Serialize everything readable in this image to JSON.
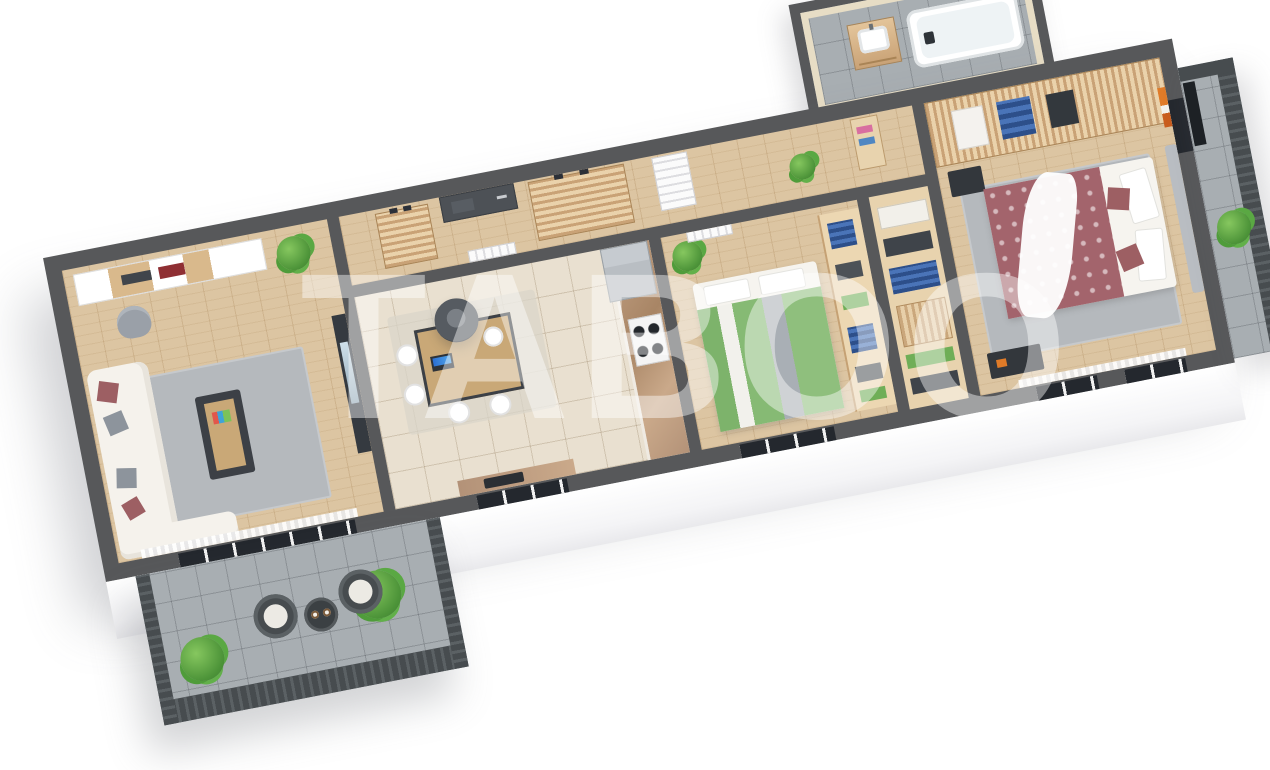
{
  "meta": {
    "type": "3d-isometric-floor-plan-render",
    "description": "Cutaway top-down 3D rendering of a 3-room apartment on a white background, rotated diagonally with the right end higher",
    "background": "#ffffff"
  },
  "watermark": {
    "text": "TABOO",
    "color": "#ffffff",
    "opacity": 0.44
  },
  "palette": {
    "wall_top": "#57585a",
    "wood_floor": "#dcc5a2",
    "kitchen_tile": "#e9e0d0",
    "balcony_tile": "#a8aeb2",
    "railing": "#474c4f",
    "wardrobe_wood": "#e0c49c",
    "sofa_white": "#f5f2ec",
    "pillow_red": "#9d5f63",
    "pillow_gray": "#8d949c",
    "bed_green": "#83b871",
    "bed_mauve": "#a3646c",
    "bath_wall_travertine": "#e7ddc5",
    "counter_marble": "#b59478",
    "plant_green": "#4d9439",
    "accent_orange": "#e07b28"
  },
  "rooms": [
    {
      "id": "living-room",
      "label": "Living room",
      "furniture": [
        "wall-shelving-unit",
        "decor-books",
        "armchair",
        "palm-plant",
        "corner-sofa",
        "red-pillows",
        "gray-pillows",
        "gray-rug",
        "coffee-table-magazines",
        "tv-media-wall",
        "sheer-curtain",
        "sliding-balcony-door",
        "open-white-door"
      ]
    },
    {
      "id": "main-balcony",
      "label": "Balcony (living room)",
      "furniture": [
        "slat-railing",
        "rattan-chair-left",
        "rattan-chair-right",
        "bistro-table-two-cups",
        "potted-plant-left",
        "potted-plant-right",
        "gray-tile-floor"
      ]
    },
    {
      "id": "hallway",
      "label": "Entrance hall",
      "furniture": [
        "entrance-door-dark",
        "shoe-cabinet-small",
        "shoe-cabinet-large",
        "shoes-pairs",
        "white-interior-doors",
        "storage-niche-towels",
        "potted-plant"
      ]
    },
    {
      "id": "kitchen-dining",
      "label": "Kitchen / dining",
      "furniture": [
        "kitchen-counter-marble",
        "gas-hob-4-burners",
        "refrigerator",
        "sink-counter-dark",
        "dining-table-laptop",
        "pendant-lamp",
        "white-chairs",
        "area-carpet",
        "window"
      ]
    },
    {
      "id": "bedroom-green",
      "label": "Bedroom 1",
      "furniture": [
        "double-bed-green-bedding",
        "white-pillows",
        "open-wardrobe-hanging-clothes",
        "folded-clothes-shelves",
        "potted-plant",
        "white-door",
        "window"
      ]
    },
    {
      "id": "walkin-closet",
      "label": "Walk-in closet strip",
      "furniture": [
        "hanging-shirts-blue",
        "folded-green-clothes",
        "storage-bags"
      ]
    },
    {
      "id": "bathroom",
      "label": "Bathroom",
      "furniture": [
        "bathtub",
        "vanity-cabinet-sink",
        "faucet",
        "travertine-walls",
        "gray-tile-floor"
      ]
    },
    {
      "id": "bedroom-mauve",
      "label": "Bedroom 2 (master)",
      "furniture": [
        "double-bed-mauve-bedding",
        "white-throw-blanket",
        "gray-headboard",
        "slat-wardrobe-clothes",
        "nightstand",
        "dresser-dark",
        "wall-art-orange",
        "gray-rug",
        "balcony-door-dark",
        "windows"
      ]
    },
    {
      "id": "side-balcony",
      "label": "Balcony (bedroom)",
      "furniture": [
        "slat-railing",
        "potted-plant",
        "radiator-panel-dark",
        "gray-tile-floor"
      ]
    }
  ]
}
